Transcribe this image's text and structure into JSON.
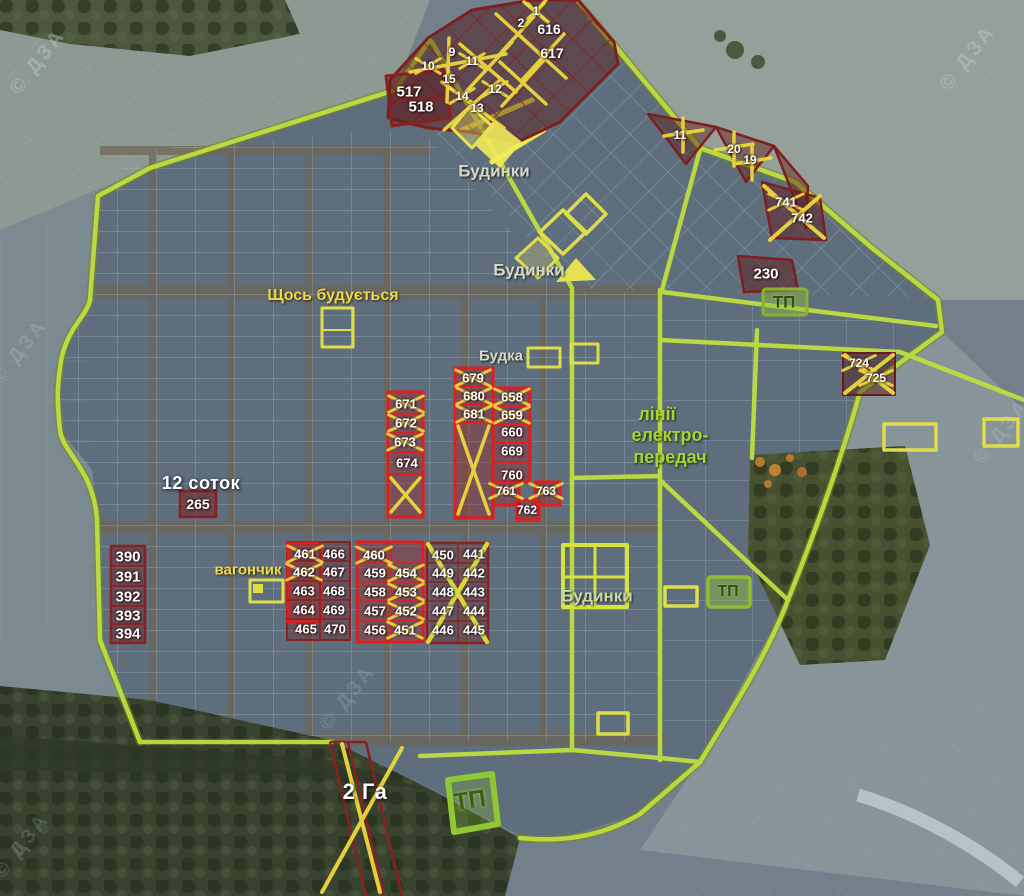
{
  "map": {
    "watermark_text": "© ДЗА",
    "colors": {
      "boundary_green": "#bede3e",
      "plot_grid_blue": "#a6cbe2",
      "sold_red": "#e31c1c",
      "reserved_maroon": "#8a2020",
      "cross_yellow": "#f0d83c",
      "label_yellow": "#ead84e",
      "power_line_green": "#a6d434"
    },
    "area_labels": [
      {
        "text": "Будинки",
        "x": 494,
        "y": 171,
        "style": "place",
        "size": 17
      },
      {
        "text": "Будинки",
        "x": 529,
        "y": 270,
        "style": "place",
        "size": 17
      },
      {
        "text": "Будинки",
        "x": 597,
        "y": 596,
        "style": "place2",
        "size": 17
      },
      {
        "text": "Щось будується",
        "x": 333,
        "y": 296,
        "style": "yellow",
        "size": 16
      },
      {
        "text": "Будка",
        "x": 501,
        "y": 356,
        "style": "place",
        "size": 15
      },
      {
        "text": "вагончик",
        "x": 248,
        "y": 570,
        "style": "yellow",
        "size": 15
      },
      {
        "text": "лінії",
        "x": 657,
        "y": 414,
        "style": "green",
        "size": 18
      },
      {
        "text": "електро-",
        "x": 670,
        "y": 435,
        "style": "green",
        "size": 18
      },
      {
        "text": "передач",
        "x": 670,
        "y": 457,
        "style": "green",
        "size": 18
      },
      {
        "text": "12 соток",
        "x": 201,
        "y": 483,
        "style": "whitebig",
        "size": 18
      },
      {
        "text": "2 Га",
        "x": 365,
        "y": 792,
        "style": "whitebig",
        "size": 22
      },
      {
        "text": "ТП",
        "x": 784,
        "y": 302,
        "style": "tp",
        "size": 17
      },
      {
        "text": "ТП",
        "x": 728,
        "y": 592,
        "style": "tp",
        "size": 16
      },
      {
        "text": "ТП",
        "x": 470,
        "y": 801,
        "style": "tpbig",
        "size": 24,
        "rot": -8
      }
    ],
    "plot_numbers": [
      {
        "n": "1",
        "x": 536,
        "y": 11,
        "size": 12,
        "c": true
      },
      {
        "n": "2",
        "x": 521,
        "y": 23,
        "size": 12,
        "c": false
      },
      {
        "n": "616",
        "x": 549,
        "y": 29,
        "size": 14,
        "c": false
      },
      {
        "n": "617",
        "x": 552,
        "y": 53,
        "size": 14,
        "c": false
      },
      {
        "n": "9",
        "x": 452,
        "y": 52,
        "size": 12,
        "c": false
      },
      {
        "n": "10",
        "x": 428,
        "y": 66,
        "size": 12,
        "c": true
      },
      {
        "n": "11",
        "x": 472,
        "y": 61,
        "size": 12,
        "c": true
      },
      {
        "n": "15",
        "x": 449,
        "y": 79,
        "size": 12,
        "c": false
      },
      {
        "n": "14",
        "x": 462,
        "y": 96,
        "size": 12,
        "c": true
      },
      {
        "n": "12",
        "x": 495,
        "y": 89,
        "size": 12,
        "c": true
      },
      {
        "n": "13",
        "x": 477,
        "y": 108,
        "size": 12,
        "c": false
      },
      {
        "n": "517",
        "x": 409,
        "y": 92,
        "size": 15,
        "c": false
      },
      {
        "n": "518",
        "x": 421,
        "y": 107,
        "size": 15,
        "c": false
      },
      {
        "n": "11",
        "x": 680,
        "y": 135,
        "size": 12,
        "c": false
      },
      {
        "n": "20",
        "x": 734,
        "y": 149,
        "size": 12,
        "c": false
      },
      {
        "n": "19",
        "x": 750,
        "y": 160,
        "size": 12,
        "c": false
      },
      {
        "n": "741",
        "x": 786,
        "y": 202,
        "size": 13,
        "c": true
      },
      {
        "n": "742",
        "x": 802,
        "y": 218,
        "size": 13,
        "c": false
      },
      {
        "n": "230",
        "x": 766,
        "y": 274,
        "size": 15,
        "c": false
      },
      {
        "n": "724",
        "x": 859,
        "y": 363,
        "size": 12,
        "c": true
      },
      {
        "n": "725",
        "x": 876,
        "y": 378,
        "size": 12,
        "c": true
      },
      {
        "n": "671",
        "x": 406,
        "y": 404,
        "size": 13,
        "c": true
      },
      {
        "n": "672",
        "x": 406,
        "y": 423,
        "size": 13,
        "c": true
      },
      {
        "n": "673",
        "x": 405,
        "y": 442,
        "size": 13,
        "c": true
      },
      {
        "n": "674",
        "x": 407,
        "y": 463,
        "size": 13,
        "c": false
      },
      {
        "n": "679",
        "x": 473,
        "y": 378,
        "size": 13,
        "c": true
      },
      {
        "n": "680",
        "x": 474,
        "y": 396,
        "size": 13,
        "c": true
      },
      {
        "n": "681",
        "x": 474,
        "y": 414,
        "size": 13,
        "c": true
      },
      {
        "n": "658",
        "x": 512,
        "y": 397,
        "size": 13,
        "c": true
      },
      {
        "n": "659",
        "x": 512,
        "y": 415,
        "size": 13,
        "c": true
      },
      {
        "n": "660",
        "x": 512,
        "y": 432,
        "size": 13,
        "c": false
      },
      {
        "n": "669",
        "x": 512,
        "y": 451,
        "size": 13,
        "c": false
      },
      {
        "n": "760",
        "x": 512,
        "y": 475,
        "size": 13,
        "c": false
      },
      {
        "n": "761",
        "x": 506,
        "y": 491,
        "size": 12,
        "c": true
      },
      {
        "n": "762",
        "x": 527,
        "y": 510,
        "size": 12,
        "c": false
      },
      {
        "n": "763",
        "x": 546,
        "y": 491,
        "size": 12,
        "c": true
      },
      {
        "n": "265",
        "x": 198,
        "y": 504,
        "size": 14,
        "c": false
      },
      {
        "n": "390",
        "x": 128,
        "y": 557,
        "size": 15,
        "c": false
      },
      {
        "n": "391",
        "x": 128,
        "y": 577,
        "size": 15,
        "c": false
      },
      {
        "n": "392",
        "x": 128,
        "y": 597,
        "size": 15,
        "c": false
      },
      {
        "n": "393",
        "x": 128,
        "y": 616,
        "size": 15,
        "c": false
      },
      {
        "n": "394",
        "x": 128,
        "y": 634,
        "size": 15,
        "c": false
      },
      {
        "n": "461",
        "x": 305,
        "y": 554,
        "size": 13,
        "c": true
      },
      {
        "n": "466",
        "x": 334,
        "y": 554,
        "size": 13,
        "c": false
      },
      {
        "n": "462",
        "x": 304,
        "y": 572,
        "size": 13,
        "c": true
      },
      {
        "n": "467",
        "x": 334,
        "y": 572,
        "size": 13,
        "c": false
      },
      {
        "n": "463",
        "x": 304,
        "y": 591,
        "size": 13,
        "c": false
      },
      {
        "n": "468",
        "x": 334,
        "y": 591,
        "size": 13,
        "c": false
      },
      {
        "n": "464",
        "x": 304,
        "y": 610,
        "size": 13,
        "c": false
      },
      {
        "n": "469",
        "x": 334,
        "y": 610,
        "size": 13,
        "c": false
      },
      {
        "n": "465",
        "x": 306,
        "y": 629,
        "size": 13,
        "c": false
      },
      {
        "n": "470",
        "x": 335,
        "y": 629,
        "size": 13,
        "c": false
      },
      {
        "n": "460",
        "x": 374,
        "y": 555,
        "size": 13,
        "c": true
      },
      {
        "n": "459",
        "x": 375,
        "y": 573,
        "size": 13,
        "c": false
      },
      {
        "n": "458",
        "x": 375,
        "y": 592,
        "size": 13,
        "c": false
      },
      {
        "n": "457",
        "x": 375,
        "y": 611,
        "size": 13,
        "c": false
      },
      {
        "n": "456",
        "x": 375,
        "y": 630,
        "size": 13,
        "c": false
      },
      {
        "n": "454",
        "x": 406,
        "y": 573,
        "size": 13,
        "c": true
      },
      {
        "n": "453",
        "x": 406,
        "y": 592,
        "size": 13,
        "c": true
      },
      {
        "n": "452",
        "x": 406,
        "y": 611,
        "size": 13,
        "c": true
      },
      {
        "n": "451",
        "x": 405,
        "y": 630,
        "size": 13,
        "c": true
      },
      {
        "n": "450",
        "x": 443,
        "y": 555,
        "size": 13,
        "c": false
      },
      {
        "n": "441",
        "x": 474,
        "y": 554,
        "size": 13,
        "c": false
      },
      {
        "n": "449",
        "x": 443,
        "y": 573,
        "size": 13,
        "c": false
      },
      {
        "n": "442",
        "x": 474,
        "y": 573,
        "size": 13,
        "c": false
      },
      {
        "n": "448",
        "x": 443,
        "y": 592,
        "size": 13,
        "c": false
      },
      {
        "n": "443",
        "x": 474,
        "y": 592,
        "size": 13,
        "c": false
      },
      {
        "n": "447",
        "x": 443,
        "y": 611,
        "size": 13,
        "c": false
      },
      {
        "n": "444",
        "x": 474,
        "y": 611,
        "size": 13,
        "c": false
      },
      {
        "n": "446",
        "x": 443,
        "y": 630,
        "size": 13,
        "c": false
      },
      {
        "n": "445",
        "x": 474,
        "y": 630,
        "size": 13,
        "c": false
      }
    ]
  }
}
